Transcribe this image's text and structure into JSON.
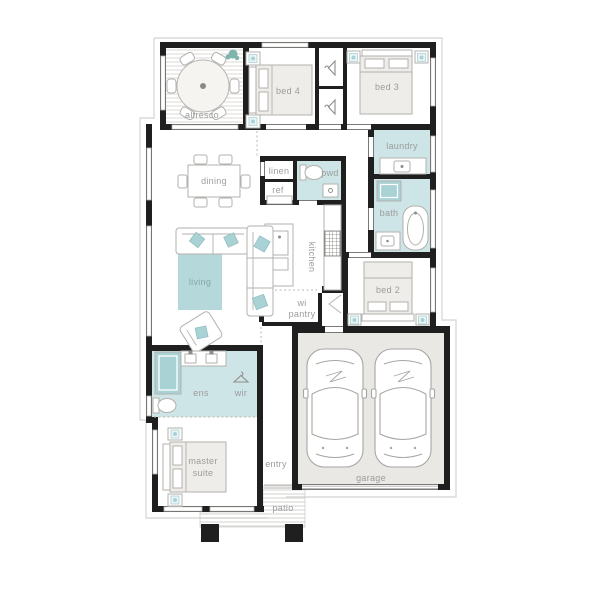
{
  "title": "single-storey home floor plan",
  "colors": {
    "wall": "#1f1f1f",
    "wet": "#cde5e6",
    "accent": "#a9d2d5",
    "rug": "#b5d9da",
    "garage_floor": "#e9e8e5",
    "bed_fill": "#efede9",
    "furniture_stroke": "#b3b1ad",
    "label": "#9c9c9c",
    "label_on_rug": "#84a7a9",
    "eave": "#dcdad7",
    "hatch": "#dcdad6",
    "hatch_patio": "#d2d0cc"
  },
  "labels": {
    "alfresco": "alfresco",
    "bed4": "bed 4",
    "bed3": "bed 3",
    "laundry": "laundry",
    "dining": "dining",
    "linen": "linen",
    "pwd": "pwd",
    "ref": "ref",
    "bath": "bath",
    "living": "living",
    "kitchen": "kitchen",
    "wi_pantry_1": "wi",
    "wi_pantry_2": "pantry",
    "bed2": "bed 2",
    "ens": "ens",
    "wir": "wir",
    "master_1": "master",
    "master_2": "suite",
    "entry": "entry",
    "garage": "garage",
    "patio": "patio"
  }
}
